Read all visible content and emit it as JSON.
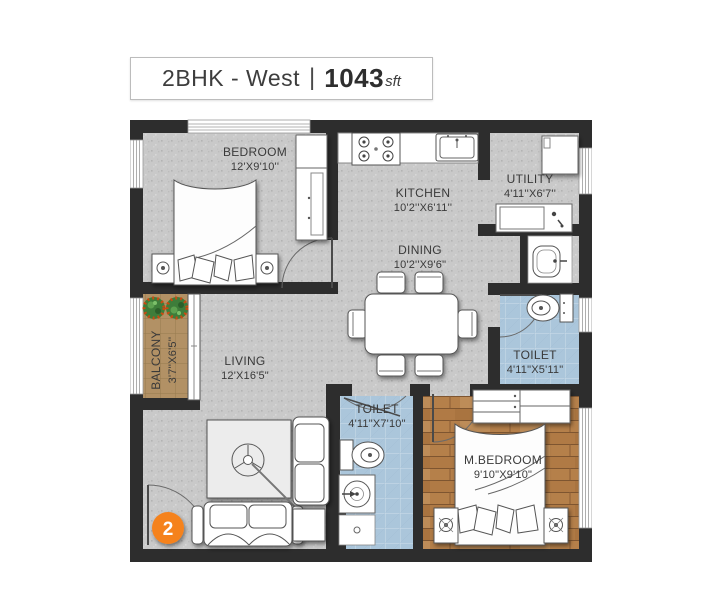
{
  "title": {
    "plan_type": "2BHK - West",
    "separator": "|",
    "area": "1043",
    "area_unit": "sft"
  },
  "rooms": {
    "bedroom": {
      "label": "BEDROOM",
      "dims": "12'X9'10''"
    },
    "kitchen": {
      "label": "KITCHEN",
      "dims": "10'2''X6'11''"
    },
    "utility": {
      "label": "UTILITY",
      "dims": "4'11''X6'7''"
    },
    "dining": {
      "label": "DINING",
      "dims": "10'2''X9'6\""
    },
    "toilet_right": {
      "label": "TOILET",
      "dims": "4'11\"X5'11\""
    },
    "balcony": {
      "label": "BALCONY",
      "dims": "3'7''X6'5''"
    },
    "living": {
      "label": "LIVING",
      "dims": "12'X16'5\""
    },
    "toilet_bottom": {
      "label": "TOILET",
      "dims": "4'11\"X7'10\""
    },
    "master_bedroom": {
      "label": "M.BEDROOM",
      "dims": "9'10\"X9'10\""
    }
  },
  "entrance": {
    "unit_number": "2"
  },
  "colors": {
    "wall": "#2d2d2d",
    "marker_orange": "#f5821f",
    "floor_gray": "#c9c9c9",
    "toilet_tile_blue": "#abc6db",
    "wood_brown": "#b5804a",
    "balcony_tile_tan": "#b29165"
  }
}
